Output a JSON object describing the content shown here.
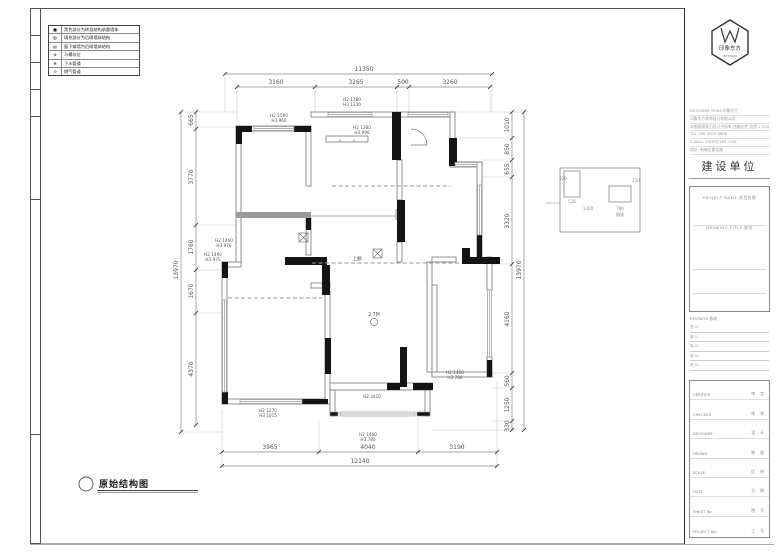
{
  "sheet": {
    "caption": "原始结构图"
  },
  "legend": {
    "rows": [
      {
        "symbol": "■",
        "label": "黑色部分为砖混结构承重墙体"
      },
      {
        "symbol": "▨",
        "label": "填充部分为后砌墙体结构"
      },
      {
        "symbol": "▤",
        "label": "窗下矮墙为后砌墙体结构"
      },
      {
        "symbol": "⊕",
        "label": "马桶坑位"
      },
      {
        "symbol": "✻",
        "label": "下水管道"
      },
      {
        "symbol": "⊙",
        "label": "燃气管道"
      }
    ]
  },
  "plan": {
    "dims": {
      "top_total": "11350",
      "top": [
        "3160",
        "3265",
        "500",
        "3260"
      ],
      "bottom": [
        "3965",
        "4040",
        "3190"
      ],
      "bottom_total": "12140",
      "left": [
        "665",
        "3770",
        "1760",
        "1670",
        "4370"
      ],
      "left_total": "13970",
      "right": [
        "1010",
        "850",
        "655",
        "3320",
        "4160",
        "560",
        "1250",
        "330"
      ],
      "right_total": "13970"
    },
    "win_labels": {
      "top_center": [
        "H2 1780",
        "H3 1130"
      ],
      "top_left": [
        "H2 1560",
        "H3 960"
      ],
      "top_right": [
        "H2 1380",
        "H3 990"
      ],
      "left_upper": [
        "H2 1460",
        "H3 970"
      ],
      "left_lower": [
        "H2 1490",
        "H3 975"
      ],
      "bottom_right": [
        "H2 1460",
        "H3 780"
      ],
      "balcony": [
        "H2 1460",
        "H3 780"
      ],
      "bottom_left": [
        "H2 1270",
        "H3 1015"
      ]
    },
    "beam_label": "上翻",
    "room_marker": "2.7M",
    "balcony_label": "H2 2410",
    "detail": {
      "labels": [
        "320",
        "528",
        "250",
        "1300",
        "780",
        "烟道"
      ]
    }
  },
  "titleblock": {
    "logo": {
      "name": "印象东方",
      "sub": "INTERIOR"
    },
    "info_lines": [
      "DESIGNER TEAM  印象东方",
      "印象东方装饰设计有限公司",
      "本图纸版权归设计方所有 违者必究 比例 1:100",
      "TEL:186 0000 8888",
      "E-MAIL: YXDF@163.COM",
      "地址: 新城区建设路"
    ],
    "unit_label": "建设单位",
    "project_label": "PROJECT NAME  项目名称",
    "drawing_label": "DRAWING TITLE  图名",
    "revision_label": "REVISION 修改",
    "revision_rows": [
      "图-01",
      "图-02",
      "图-03",
      "图-04",
      "图-05"
    ],
    "sign_rows": [
      {
        "en": "VERIFIER",
        "cn": "审 定"
      },
      {
        "en": "CHECKED",
        "cn": "审 核"
      },
      {
        "en": "DESIGNER",
        "cn": "设 计"
      },
      {
        "en": "DRAWN",
        "cn": "制 图"
      },
      {
        "en": "SCALE",
        "cn": "比 例"
      },
      {
        "en": "DATE",
        "cn": "日 期"
      },
      {
        "en": "SHEET No.",
        "cn": "图 号"
      },
      {
        "en": "PROJECT No.",
        "cn": "工 号"
      }
    ]
  }
}
